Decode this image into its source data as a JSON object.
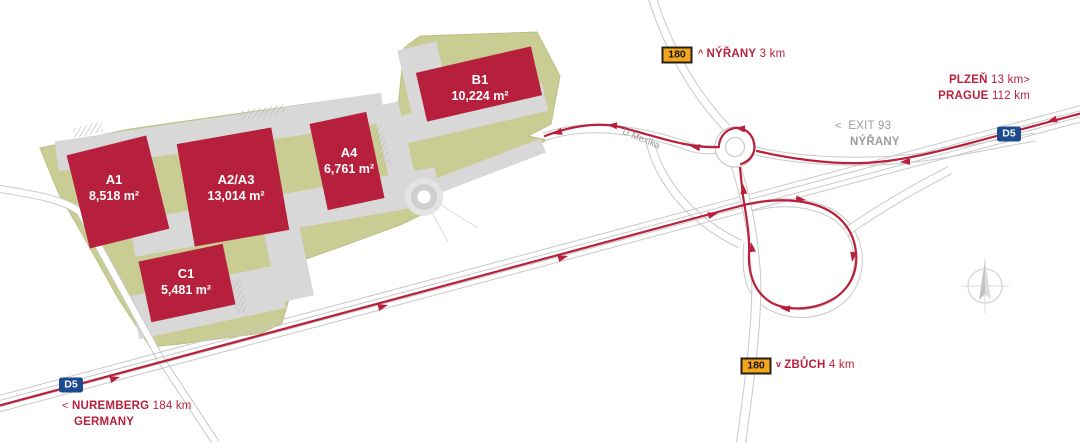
{
  "map_title": "industrial-park-access-map",
  "buildings": [
    {
      "id": "a1",
      "name": "A1",
      "area": "8,518 m²"
    },
    {
      "id": "a2a3",
      "name": "A2/A3",
      "area": "13,014 m²"
    },
    {
      "id": "a4",
      "name": "A4",
      "area": "6,761 m²"
    },
    {
      "id": "b1",
      "name": "B1",
      "area": "10,224 m²"
    },
    {
      "id": "c1",
      "name": "C1",
      "area": "5,481 m²"
    }
  ],
  "badges": {
    "d5": "D5",
    "route180": "180"
  },
  "street": {
    "label": "U Mexika"
  },
  "directions": {
    "nyrany_road": {
      "caret": "^",
      "name": "NÝŘANY",
      "distance": "3 km"
    },
    "zbuch": {
      "caret": "v",
      "name": "ZBŮCH",
      "distance": "4 km"
    },
    "plzen": {
      "name": "PLZEŇ",
      "distance": "13 km",
      "chevron": ">"
    },
    "prague": {
      "name": "PRAGUE",
      "distance": "112 km"
    },
    "exit93": {
      "chevron": "<",
      "title": "EXIT 93",
      "subtitle": "NÝŘANY"
    },
    "nuremberg": {
      "chevron": "<",
      "name": "NUREMBERG",
      "distance": "184 km",
      "country": "GERMANY"
    }
  },
  "icons": {
    "compass": "compass-rose-north"
  },
  "colors": {
    "accent_red": "#b9203c",
    "site_green": "#c9cd93",
    "paving_gray": "#d8d8d8",
    "road_gray": "#c9c9c9",
    "gray_text": "#9c9c9c",
    "motorway_blue": "#1c4b8f",
    "route_yellow": "#f3a51b"
  }
}
